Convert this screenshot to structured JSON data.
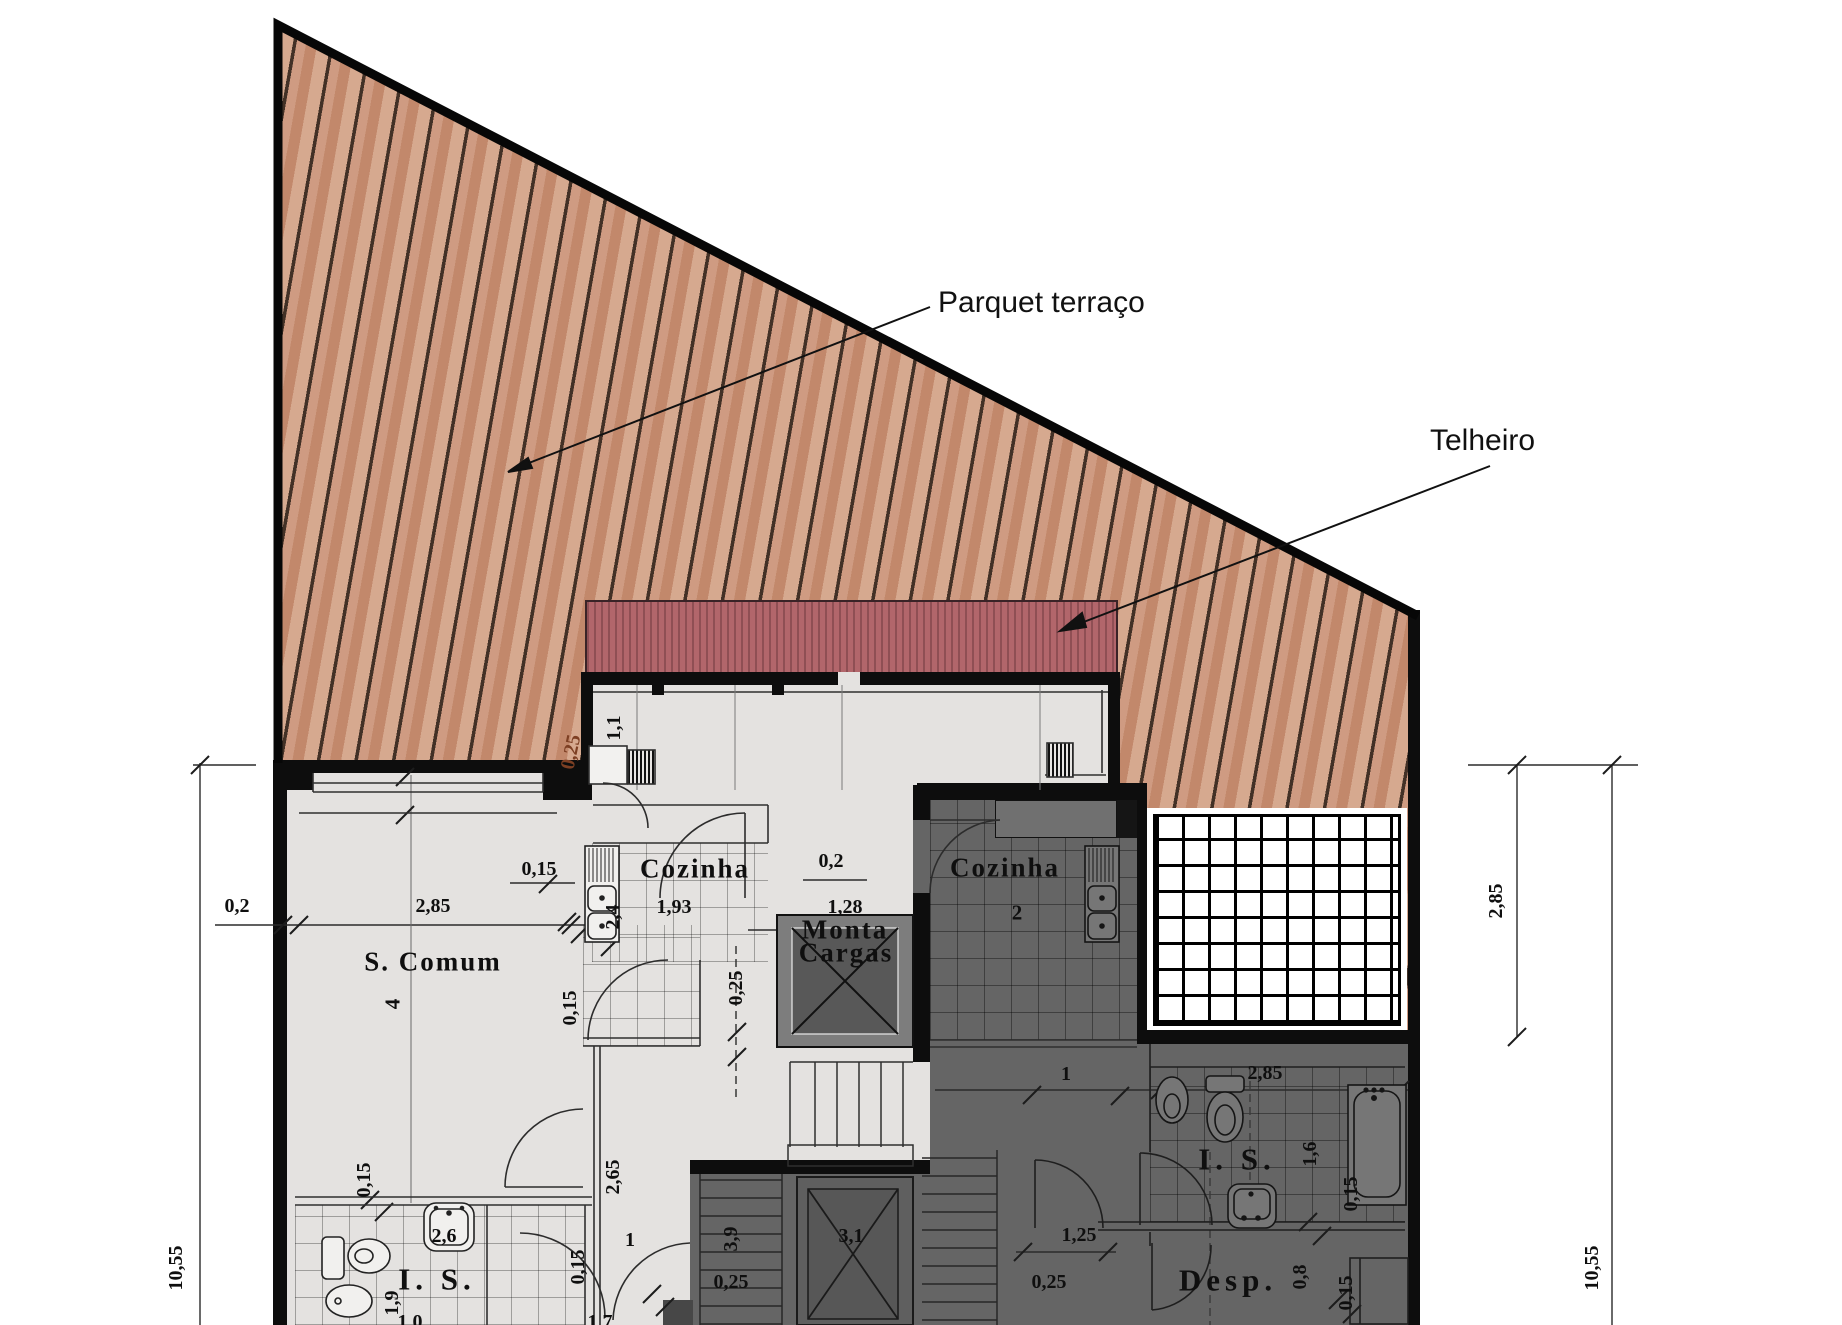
{
  "annotations": {
    "parquet_label": "Parquet terraço",
    "telheiro_label": "Telheiro"
  },
  "rooms": {
    "living": {
      "label": "S. Comum",
      "number": "4"
    },
    "kitchen_left": {
      "label": "Cozinha"
    },
    "kitchen_right": {
      "label": "Cozinha",
      "number": "2"
    },
    "lift": {
      "line1": "Monta",
      "line2": "Cargas",
      "size_label": "3,1"
    },
    "bath_left": {
      "label": "I. S."
    },
    "bath_right": {
      "label": "I. S."
    },
    "pantry": {
      "label": "Desp."
    }
  },
  "dimensions": [
    {
      "t": "0,2",
      "x": 237,
      "y": 906
    },
    {
      "t": "2,85",
      "x": 433,
      "y": 906
    },
    {
      "t": "10,55",
      "x": 176,
      "y": 1268,
      "r": -90
    },
    {
      "t": "2,85",
      "x": 1496,
      "y": 901,
      "r": -90
    },
    {
      "t": "10,55",
      "x": 1592,
      "y": 1268,
      "r": -90
    },
    {
      "t": "1,1",
      "x": 614,
      "y": 728,
      "r": -90
    },
    {
      "t": "0,25",
      "x": 571,
      "y": 752,
      "r": -78,
      "c": "#7d3f23"
    },
    {
      "t": "0,15",
      "x": 539,
      "y": 869
    },
    {
      "t": "1,93",
      "x": 674,
      "y": 907
    },
    {
      "t": "2,4",
      "x": 613,
      "y": 917,
      "r": -90
    },
    {
      "t": "0,2",
      "x": 831,
      "y": 861
    },
    {
      "t": "1,28",
      "x": 845,
      "y": 907
    },
    {
      "t": "0,25",
      "x": 736,
      "y": 988,
      "r": -90
    },
    {
      "t": "2,65",
      "x": 613,
      "y": 1177,
      "r": -90
    },
    {
      "t": "0,15",
      "x": 570,
      "y": 1008,
      "r": -90
    },
    {
      "t": "0,15",
      "x": 364,
      "y": 1180,
      "r": -90
    },
    {
      "t": "2,6",
      "x": 444,
      "y": 1236
    },
    {
      "t": "1,9",
      "x": 392,
      "y": 1303,
      "r": -90
    },
    {
      "t": "1",
      "x": 630,
      "y": 1240
    },
    {
      "t": "0,15",
      "x": 578,
      "y": 1267,
      "r": -90
    },
    {
      "t": "3,9",
      "x": 731,
      "y": 1239,
      "r": -90
    },
    {
      "t": "0,25",
      "x": 731,
      "y": 1282
    },
    {
      "t": "3,1",
      "x": 851,
      "y": 1236
    },
    {
      "t": "1",
      "x": 1066,
      "y": 1074
    },
    {
      "t": "2,85",
      "x": 1265,
      "y": 1073
    },
    {
      "t": "1,6",
      "x": 1310,
      "y": 1154,
      "r": -90
    },
    {
      "t": "0,15",
      "x": 1351,
      "y": 1194,
      "r": -90
    },
    {
      "t": "1,25",
      "x": 1079,
      "y": 1235
    },
    {
      "t": "0,25",
      "x": 1049,
      "y": 1282
    },
    {
      "t": "0,8",
      "x": 1300,
      "y": 1277,
      "r": -90
    },
    {
      "t": "0,15",
      "x": 1346,
      "y": 1293,
      "r": -90
    },
    {
      "t": "1,0",
      "x": 410,
      "y": 1322
    },
    {
      "t": "1,7",
      "x": 600,
      "y": 1322
    }
  ],
  "colors": {
    "deck_wood": "#cc9478",
    "deck_line": "#2a1e16",
    "roof_red": "#b2666b",
    "roof_stripe": "#8f4f54",
    "interior_light": "#e4e2e0",
    "interior_dark": "#656565",
    "wall_black": "#0d0d0d",
    "dim_accent_brown": "#7d3f23"
  }
}
